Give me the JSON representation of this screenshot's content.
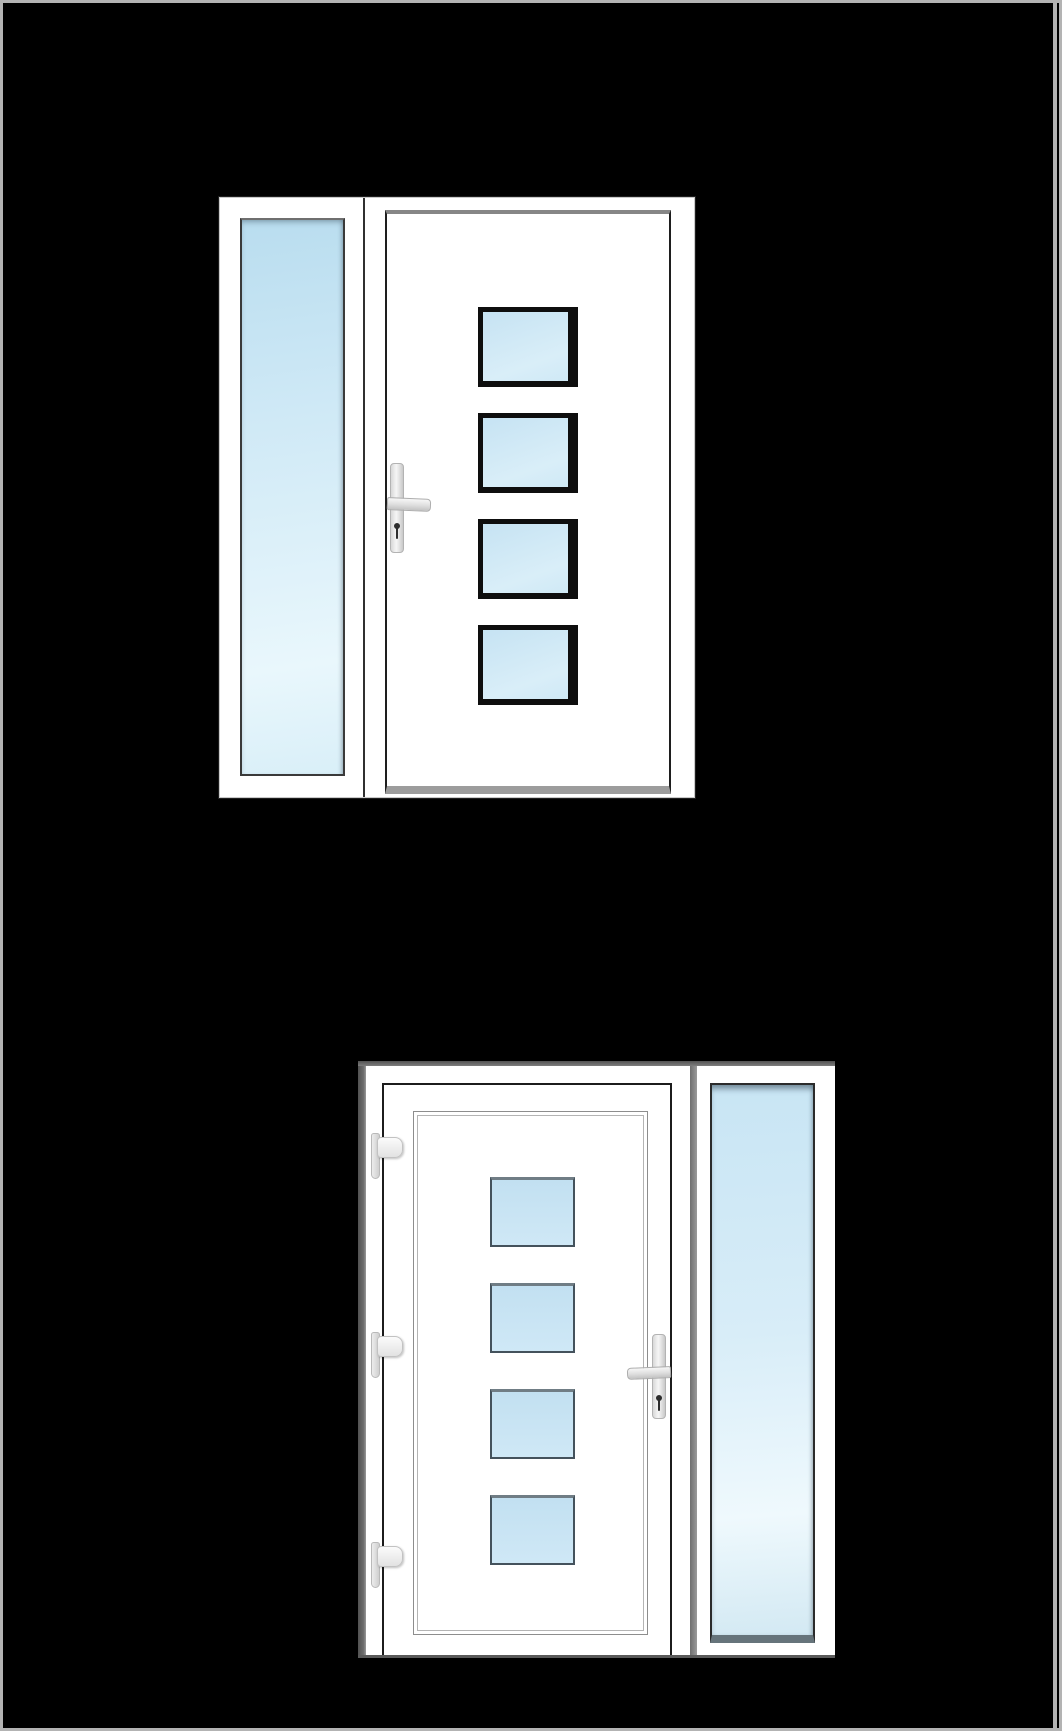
{
  "canvas": {
    "width": 1062,
    "height": 1731,
    "background": "#000000",
    "border_color": "#b3b3b3",
    "border_width": 3,
    "right_rule": {
      "x": 1053,
      "y": 0,
      "w": 4,
      "h": 1731
    }
  },
  "colors": {
    "background": "#000000",
    "frame_white": "#ffffff",
    "panel_frame_black": "#0e0e0e",
    "glass_blue": "#cde7f5",
    "glass_blue_dark": "#b9ddef",
    "glass_blue_light": "#ecf8fd",
    "shadow_gray": "#5f5f5f",
    "hardware_gray": "#dedede",
    "outline_dark": "#1e1e1e"
  },
  "assemblies": [
    {
      "id": "exterior",
      "name": "entry-door-with-left-sidelight-exterior-view",
      "view": "exterior",
      "sidelight_side": "left",
      "handle_side": "left",
      "lever_dir": "right",
      "panel_count": 4,
      "hinge_count": 0,
      "geo": {
        "x": 219,
        "y": 197,
        "w": 474,
        "h": 599
      },
      "sidelight_glass": {
        "x": 20,
        "y": 20,
        "w": 105,
        "h": 558
      },
      "frame_joint": {
        "x": 143,
        "y": 0,
        "w": 2,
        "h": 599
      },
      "leaf": {
        "x": 165,
        "y": 12,
        "w": 286,
        "h": 584
      },
      "panels": {
        "style": "ext",
        "left": 258,
        "tops": [
          109,
          215,
          321,
          427
        ],
        "w": 100,
        "h": 80
      },
      "handle": {
        "plate": {
          "x": 170,
          "y": 265,
          "w": 14,
          "h": 90
        },
        "lever": {
          "x": 167,
          "y": 299,
          "w": 44,
          "h": 13
        },
        "keyhole": {
          "x": 174,
          "y": 325,
          "w": 6,
          "h": 17
        }
      },
      "hinges": null
    },
    {
      "id": "interior",
      "name": "entry-door-with-right-sidelight-interior-view",
      "view": "interior",
      "sidelight_side": "right",
      "handle_side": "right",
      "lever_dir": "left",
      "panel_count": 4,
      "hinge_count": 3,
      "geo": {
        "x": 358,
        "y": 1061,
        "w": 477,
        "h": 597
      },
      "sidelight_glass": {
        "x": 352,
        "y": 22,
        "w": 105,
        "h": 560
      },
      "frame_joint": {
        "x": 332,
        "y": 0,
        "w": 7,
        "h": 597
      },
      "leaf": {
        "x": 24,
        "y": 22,
        "w": 290,
        "h": 575
      },
      "deco_frame": {
        "x": 55,
        "y": 50,
        "w": 233,
        "h": 522
      },
      "panels": {
        "style": "int",
        "left": 132,
        "tops": [
          116,
          222,
          328,
          434
        ],
        "w": 85,
        "h": 70
      },
      "handle": {
        "plate": {
          "x": 294,
          "y": 273,
          "w": 14,
          "h": 85
        },
        "lever": {
          "x": 269,
          "y": 305,
          "w": 44,
          "h": 12
        },
        "keyhole": {
          "x": 298,
          "y": 334,
          "w": 6,
          "h": 17
        }
      },
      "hinges": {
        "left": 13,
        "tops": [
          72,
          271,
          481
        ],
        "strip": {
          "w": 9,
          "h": 46
        },
        "block": {
          "dx": 6,
          "dy": 4,
          "w": 26,
          "h": 21
        }
      }
    }
  ]
}
